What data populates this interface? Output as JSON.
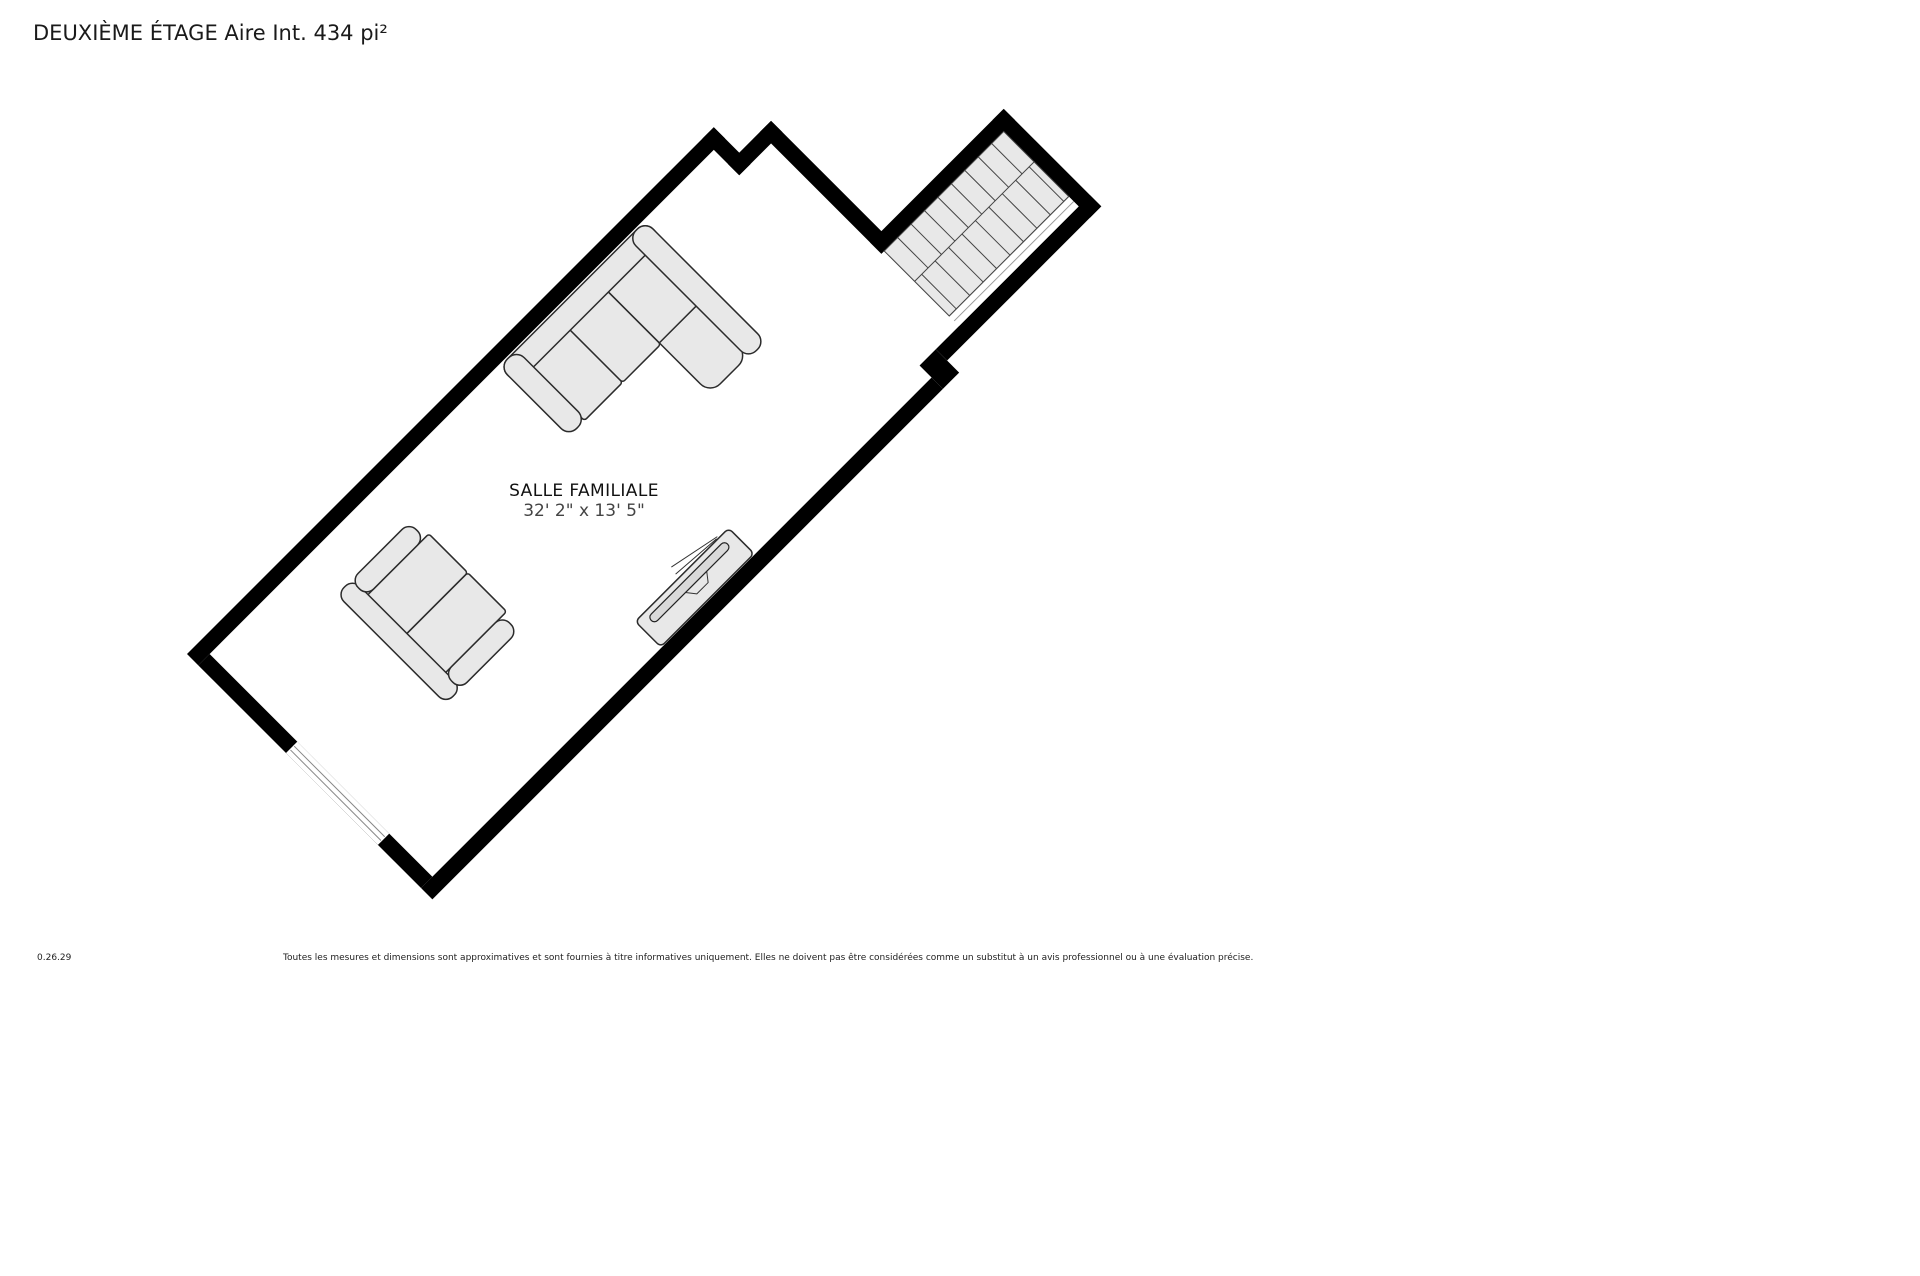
{
  "page": {
    "title": "DEUXIÈME ÉTAGE Aire Int. 434 pi²"
  },
  "room": {
    "name": "SALLE FAMILIALE",
    "dimensions": "32' 2\" x 13' 5\""
  },
  "footer": {
    "version": "0.26.29",
    "disclaimer": "Toutes les mesures et dimensions sont approximatives et sont fournies à titre informatives uniquement. Elles ne doivent pas être considérées comme un substitut à un avis professionnel ou à une évaluation précise."
  },
  "colors": {
    "wall": "#000000",
    "floor": "#ffffff",
    "stair_fill": "#e8e8e8",
    "furniture_fill": "#e8e8e8",
    "tv_fill": "#d9d9d9",
    "title_color": "#1a1a1a",
    "room_label_color": "#111111",
    "room_dimensions_color": "#444444",
    "footer_color": "#222222"
  }
}
